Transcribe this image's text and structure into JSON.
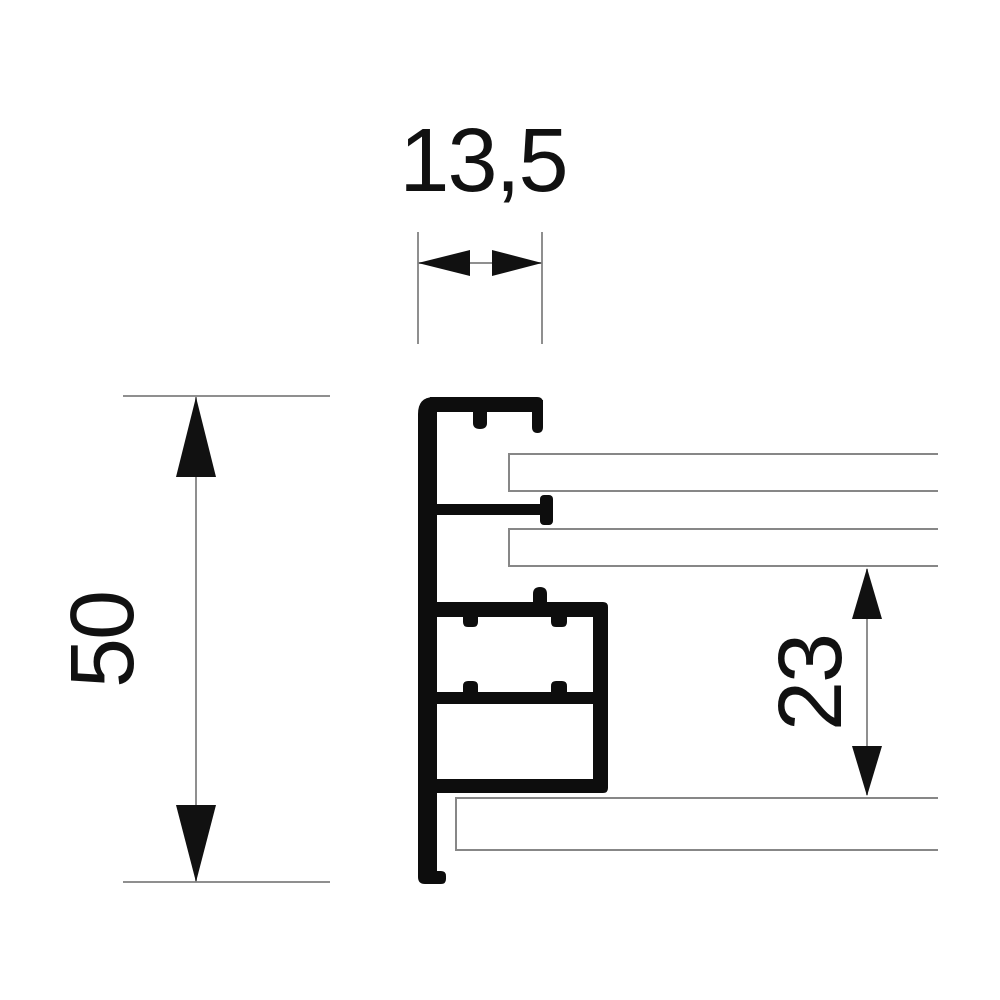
{
  "drawing": {
    "type": "technical-cross-section",
    "subject": "aluminium-frame-profile",
    "labels": {
      "top_width": "13,5",
      "left_height": "50",
      "right_offset": "23"
    },
    "colors": {
      "profile": "#0d0d0d",
      "dimension_lines": "#8f8f8f",
      "panel_outline": "#878787",
      "text": "#111111",
      "background": "#ffffff"
    }
  }
}
